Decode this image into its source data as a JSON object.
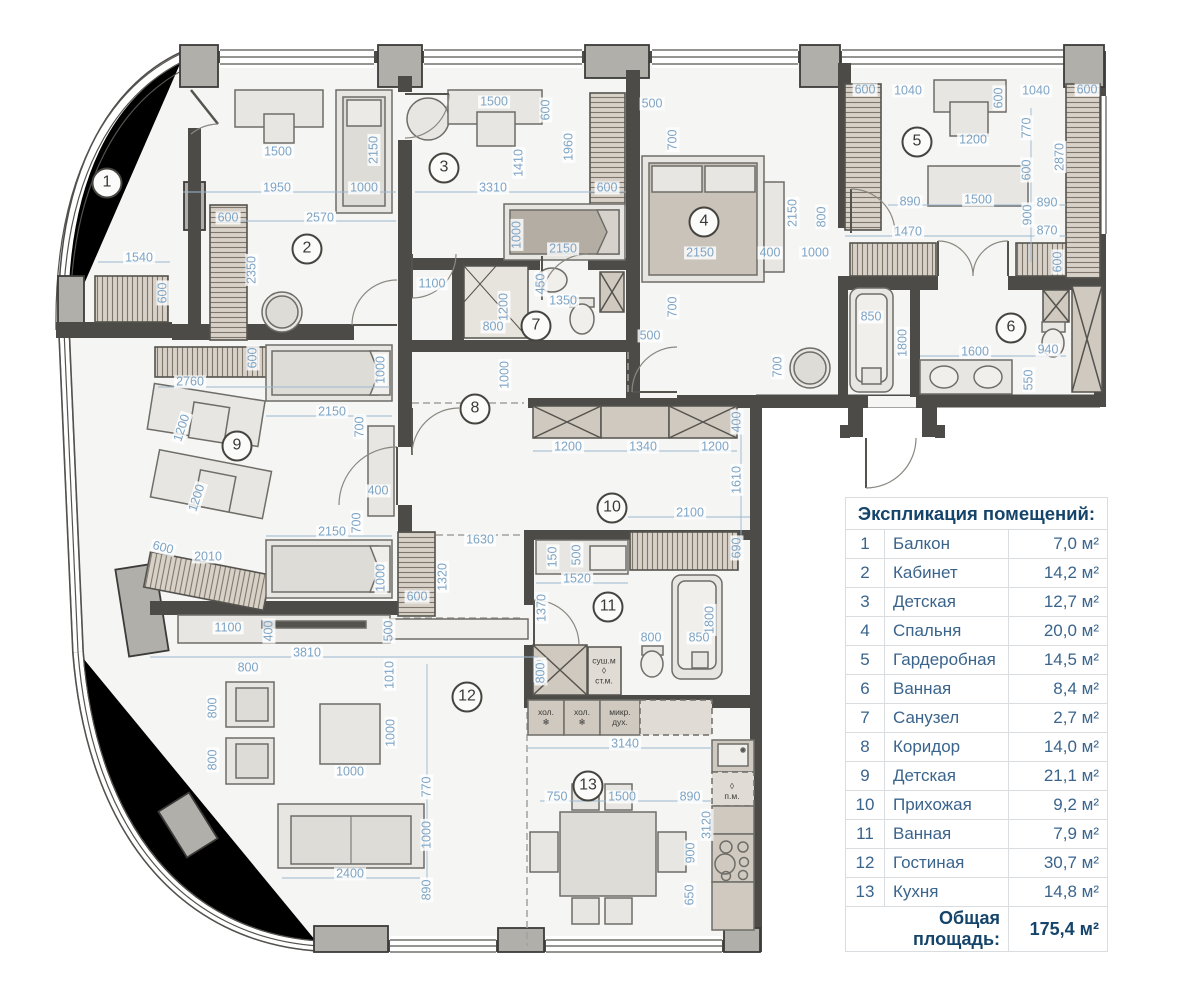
{
  "legend": {
    "title": "Экспликация помещений:",
    "rows": [
      {
        "num": "1",
        "name": "Балкон",
        "area": "7,0 м²"
      },
      {
        "num": "2",
        "name": "Кабинет",
        "area": "14,2 м²"
      },
      {
        "num": "3",
        "name": "Детская",
        "area": "12,7 м²"
      },
      {
        "num": "4",
        "name": "Спальня",
        "area": "20,0 м²"
      },
      {
        "num": "5",
        "name": "Гардеробная",
        "area": "14,5 м²"
      },
      {
        "num": "6",
        "name": "Ванная",
        "area": "8,4 м²"
      },
      {
        "num": "7",
        "name": "Санузел",
        "area": "2,7 м²"
      },
      {
        "num": "8",
        "name": "Коридор",
        "area": "14,0 м²"
      },
      {
        "num": "9",
        "name": "Детская",
        "area": "21,1 м²"
      },
      {
        "num": "10",
        "name": "Прихожая",
        "area": "9,2 м²"
      },
      {
        "num": "11",
        "name": "Ванная",
        "area": "7,9 м²"
      },
      {
        "num": "12",
        "name": "Гостиная",
        "area": "30,7 м²"
      },
      {
        "num": "13",
        "name": "Кухня",
        "area": "14,8 м²"
      }
    ],
    "total_label": "Общая площадь:",
    "total_value": "175,4 м²"
  },
  "rooms": [
    {
      "n": "1",
      "x": 107,
      "y": 183
    },
    {
      "n": "2",
      "x": 307,
      "y": 249
    },
    {
      "n": "3",
      "x": 444,
      "y": 168
    },
    {
      "n": "4",
      "x": 704,
      "y": 222
    },
    {
      "n": "5",
      "x": 917,
      "y": 142
    },
    {
      "n": "6",
      "x": 1011,
      "y": 328
    },
    {
      "n": "7",
      "x": 536,
      "y": 326
    },
    {
      "n": "8",
      "x": 475,
      "y": 409
    },
    {
      "n": "9",
      "x": 237,
      "y": 446
    },
    {
      "n": "10",
      "x": 612,
      "y": 508
    },
    {
      "n": "11",
      "x": 608,
      "y": 607
    },
    {
      "n": "12",
      "x": 467,
      "y": 697
    },
    {
      "n": "13",
      "x": 588,
      "y": 786
    }
  ],
  "dims": [
    {
      "t": "1540",
      "x": 139,
      "y": 258
    },
    {
      "t": "600",
      "x": 163,
      "y": 293,
      "r": -90
    },
    {
      "t": "1500",
      "x": 278,
      "y": 152
    },
    {
      "t": "1950",
      "x": 277,
      "y": 188
    },
    {
      "t": "1000",
      "x": 364,
      "y": 188
    },
    {
      "t": "2150",
      "x": 374,
      "y": 150,
      "r": -90
    },
    {
      "t": "2570",
      "x": 320,
      "y": 218
    },
    {
      "t": "600",
      "x": 228,
      "y": 218
    },
    {
      "t": "2350",
      "x": 252,
      "y": 270,
      "r": -90
    },
    {
      "t": "1500",
      "x": 494,
      "y": 102
    },
    {
      "t": "600",
      "x": 546,
      "y": 110,
      "r": -90
    },
    {
      "t": "1410",
      "x": 519,
      "y": 163,
      "r": -90
    },
    {
      "t": "1960",
      "x": 569,
      "y": 147,
      "r": -90
    },
    {
      "t": "3310",
      "x": 493,
      "y": 188
    },
    {
      "t": "600",
      "x": 607,
      "y": 188
    },
    {
      "t": "1000",
      "x": 517,
      "y": 235,
      "r": -90
    },
    {
      "t": "2150",
      "x": 563,
      "y": 249
    },
    {
      "t": "500",
      "x": 652,
      "y": 104
    },
    {
      "t": "700",
      "x": 673,
      "y": 140,
      "r": -90
    },
    {
      "t": "2150",
      "x": 793,
      "y": 213,
      "r": -90
    },
    {
      "t": "800",
      "x": 822,
      "y": 217,
      "r": -90
    },
    {
      "t": "2150",
      "x": 700,
      "y": 253
    },
    {
      "t": "400",
      "x": 770,
      "y": 253
    },
    {
      "t": "1000",
      "x": 815,
      "y": 253
    },
    {
      "t": "700",
      "x": 673,
      "y": 307,
      "r": -90
    },
    {
      "t": "500",
      "x": 650,
      "y": 336
    },
    {
      "t": "600",
      "x": 865,
      "y": 90
    },
    {
      "t": "1040",
      "x": 908,
      "y": 91
    },
    {
      "t": "600",
      "x": 999,
      "y": 98,
      "r": -90
    },
    {
      "t": "1040",
      "x": 1036,
      "y": 91
    },
    {
      "t": "600",
      "x": 1087,
      "y": 90
    },
    {
      "t": "1200",
      "x": 973,
      "y": 140
    },
    {
      "t": "770",
      "x": 1027,
      "y": 128,
      "r": -90
    },
    {
      "t": "2870",
      "x": 1060,
      "y": 157,
      "r": -90
    },
    {
      "t": "600",
      "x": 1027,
      "y": 170,
      "r": -90
    },
    {
      "t": "890",
      "x": 910,
      "y": 202
    },
    {
      "t": "1500",
      "x": 978,
      "y": 200
    },
    {
      "t": "890",
      "x": 1047,
      "y": 203
    },
    {
      "t": "900",
      "x": 1028,
      "y": 215,
      "r": -90
    },
    {
      "t": "1470",
      "x": 908,
      "y": 232
    },
    {
      "t": "870",
      "x": 1047,
      "y": 231
    },
    {
      "t": "600",
      "x": 1058,
      "y": 262,
      "r": -90
    },
    {
      "t": "850",
      "x": 871,
      "y": 317
    },
    {
      "t": "1800",
      "x": 903,
      "y": 343,
      "r": -90
    },
    {
      "t": "1600",
      "x": 975,
      "y": 352
    },
    {
      "t": "940",
      "x": 1048,
      "y": 350
    },
    {
      "t": "550",
      "x": 1029,
      "y": 380,
      "r": -90
    },
    {
      "t": "700",
      "x": 778,
      "y": 367,
      "r": -90
    },
    {
      "t": "1100",
      "x": 432,
      "y": 284
    },
    {
      "t": "450",
      "x": 541,
      "y": 284,
      "r": -90
    },
    {
      "t": "1350",
      "x": 563,
      "y": 301
    },
    {
      "t": "1200",
      "x": 504,
      "y": 307,
      "r": -90
    },
    {
      "t": "800",
      "x": 493,
      "y": 327
    },
    {
      "t": "1000",
      "x": 505,
      "y": 375,
      "r": -90
    },
    {
      "t": "400",
      "x": 737,
      "y": 422,
      "r": -90
    },
    {
      "t": "1200",
      "x": 568,
      "y": 447
    },
    {
      "t": "1340",
      "x": 643,
      "y": 447
    },
    {
      "t": "1200",
      "x": 715,
      "y": 447
    },
    {
      "t": "1610",
      "x": 737,
      "y": 480,
      "r": -90
    },
    {
      "t": "2100",
      "x": 690,
      "y": 513
    },
    {
      "t": "690",
      "x": 737,
      "y": 548,
      "r": -90
    },
    {
      "t": "1630",
      "x": 480,
      "y": 540
    },
    {
      "t": "1320",
      "x": 443,
      "y": 577,
      "r": -90
    },
    {
      "t": "600",
      "x": 417,
      "y": 597
    },
    {
      "t": "150",
      "x": 553,
      "y": 557,
      "r": -90
    },
    {
      "t": "500",
      "x": 577,
      "y": 555,
      "r": -90
    },
    {
      "t": "1520",
      "x": 577,
      "y": 579
    },
    {
      "t": "1370",
      "x": 542,
      "y": 608,
      "r": -90
    },
    {
      "t": "1800",
      "x": 710,
      "y": 620,
      "r": -90
    },
    {
      "t": "800",
      "x": 651,
      "y": 638
    },
    {
      "t": "850",
      "x": 699,
      "y": 638
    },
    {
      "t": "800",
      "x": 540,
      "y": 670,
      "r": -90
    },
    {
      "t": "600",
      "x": 253,
      "y": 358,
      "r": -90
    },
    {
      "t": "2760",
      "x": 190,
      "y": 382
    },
    {
      "t": "1000",
      "x": 381,
      "y": 370,
      "r": -90
    },
    {
      "t": "2150",
      "x": 332,
      "y": 412
    },
    {
      "t": "700",
      "x": 360,
      "y": 427,
      "r": -90
    },
    {
      "t": "1200",
      "x": 182,
      "y": 428,
      "r": -72
    },
    {
      "t": "1200",
      "x": 197,
      "y": 498,
      "r": -72
    },
    {
      "t": "400",
      "x": 378,
      "y": 491
    },
    {
      "t": "700",
      "x": 357,
      "y": 523,
      "r": -90
    },
    {
      "t": "2150",
      "x": 332,
      "y": 532
    },
    {
      "t": "1000",
      "x": 381,
      "y": 578,
      "r": -90
    },
    {
      "t": "600",
      "x": 163,
      "y": 548,
      "r": 14
    },
    {
      "t": "2010",
      "x": 208,
      "y": 557
    },
    {
      "t": "1100",
      "x": 228,
      "y": 628
    },
    {
      "t": "400",
      "x": 269,
      "y": 631,
      "r": -90
    },
    {
      "t": "500",
      "x": 389,
      "y": 631,
      "r": -90
    },
    {
      "t": "3810",
      "x": 307,
      "y": 653
    },
    {
      "t": "800",
      "x": 248,
      "y": 668
    },
    {
      "t": "1010",
      "x": 390,
      "y": 675,
      "r": -90
    },
    {
      "t": "800",
      "x": 213,
      "y": 708,
      "r": -90
    },
    {
      "t": "1000",
      "x": 391,
      "y": 733,
      "r": -90
    },
    {
      "t": "800",
      "x": 213,
      "y": 760,
      "r": -90
    },
    {
      "t": "1000",
      "x": 350,
      "y": 772
    },
    {
      "t": "770",
      "x": 427,
      "y": 787,
      "r": -90
    },
    {
      "t": "1000",
      "x": 427,
      "y": 835,
      "r": -90
    },
    {
      "t": "2400",
      "x": 350,
      "y": 874
    },
    {
      "t": "890",
      "x": 427,
      "y": 890,
      "r": -90
    },
    {
      "t": "800",
      "x": 541,
      "y": 673,
      "r": -90
    },
    {
      "t": "3140",
      "x": 625,
      "y": 744
    },
    {
      "t": "750",
      "x": 557,
      "y": 797
    },
    {
      "t": "1500",
      "x": 622,
      "y": 797
    },
    {
      "t": "890",
      "x": 690,
      "y": 797
    },
    {
      "t": "3120",
      "x": 707,
      "y": 825,
      "r": -90
    },
    {
      "t": "900",
      "x": 691,
      "y": 853,
      "r": -90
    },
    {
      "t": "650",
      "x": 690,
      "y": 895,
      "r": -90
    }
  ],
  "notes": [
    {
      "t": "хол.\n❄",
      "x": 546,
      "y": 718
    },
    {
      "t": "хол.\n❄",
      "x": 582,
      "y": 718
    },
    {
      "t": "микр.\nдух.",
      "x": 620,
      "y": 718
    },
    {
      "t": "суш.м\n◊\nст.м.",
      "x": 604,
      "y": 671
    },
    {
      "t": "◊\nп.м.",
      "x": 732,
      "y": 792
    }
  ],
  "colors": {
    "wall": "#4c4b48",
    "pillar": "#b1afaa",
    "floor": "#f5f5f3",
    "dim_text": "#7da4c5",
    "hatch_bg": "#d7d1c8",
    "hatch_line": "#7f776b",
    "furniture": "#e7e6e2",
    "bed": "#b4ada3",
    "legend_text": "#3a648c",
    "legend_title": "#15446a"
  }
}
